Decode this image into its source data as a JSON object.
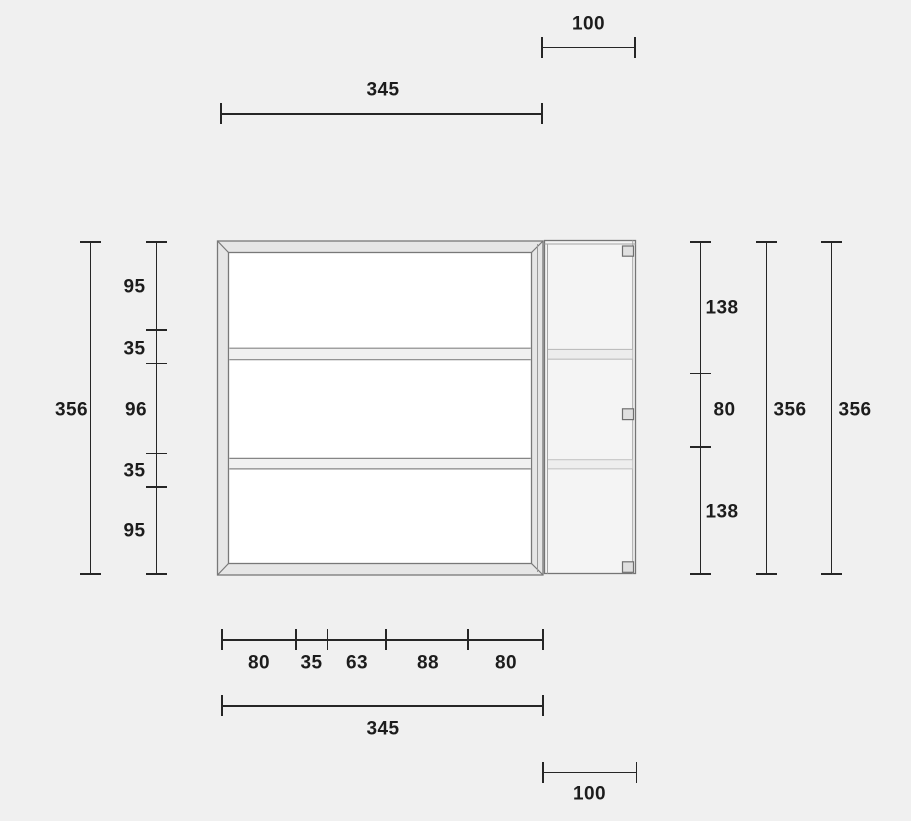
{
  "dimensions": {
    "top": {
      "side_unit_width": "100",
      "main_width": "345"
    },
    "left": {
      "overall_height": "356",
      "segments": [
        "95",
        "35",
        "96",
        "35",
        "95"
      ]
    },
    "right": {
      "segments": [
        "138",
        "80",
        "138"
      ],
      "overall_height_inner": "356",
      "overall_height_outer": "356"
    },
    "bottom": {
      "segments": [
        "80",
        "35",
        "63",
        "88",
        "80"
      ],
      "main_width": "345",
      "side_unit_width": "100"
    }
  },
  "colors": {
    "background": "#f0f0f0",
    "dimension_line": "#262626",
    "label_text": "#1c1c1c",
    "frame_fill": "#e6e6e6",
    "frame_stroke": "#787878",
    "interior_fill": "#ffffff",
    "shelf_fill": "#f0f0f0",
    "door_fill": "#f4f4f4",
    "hinge_fill": "#e0e0e0"
  }
}
